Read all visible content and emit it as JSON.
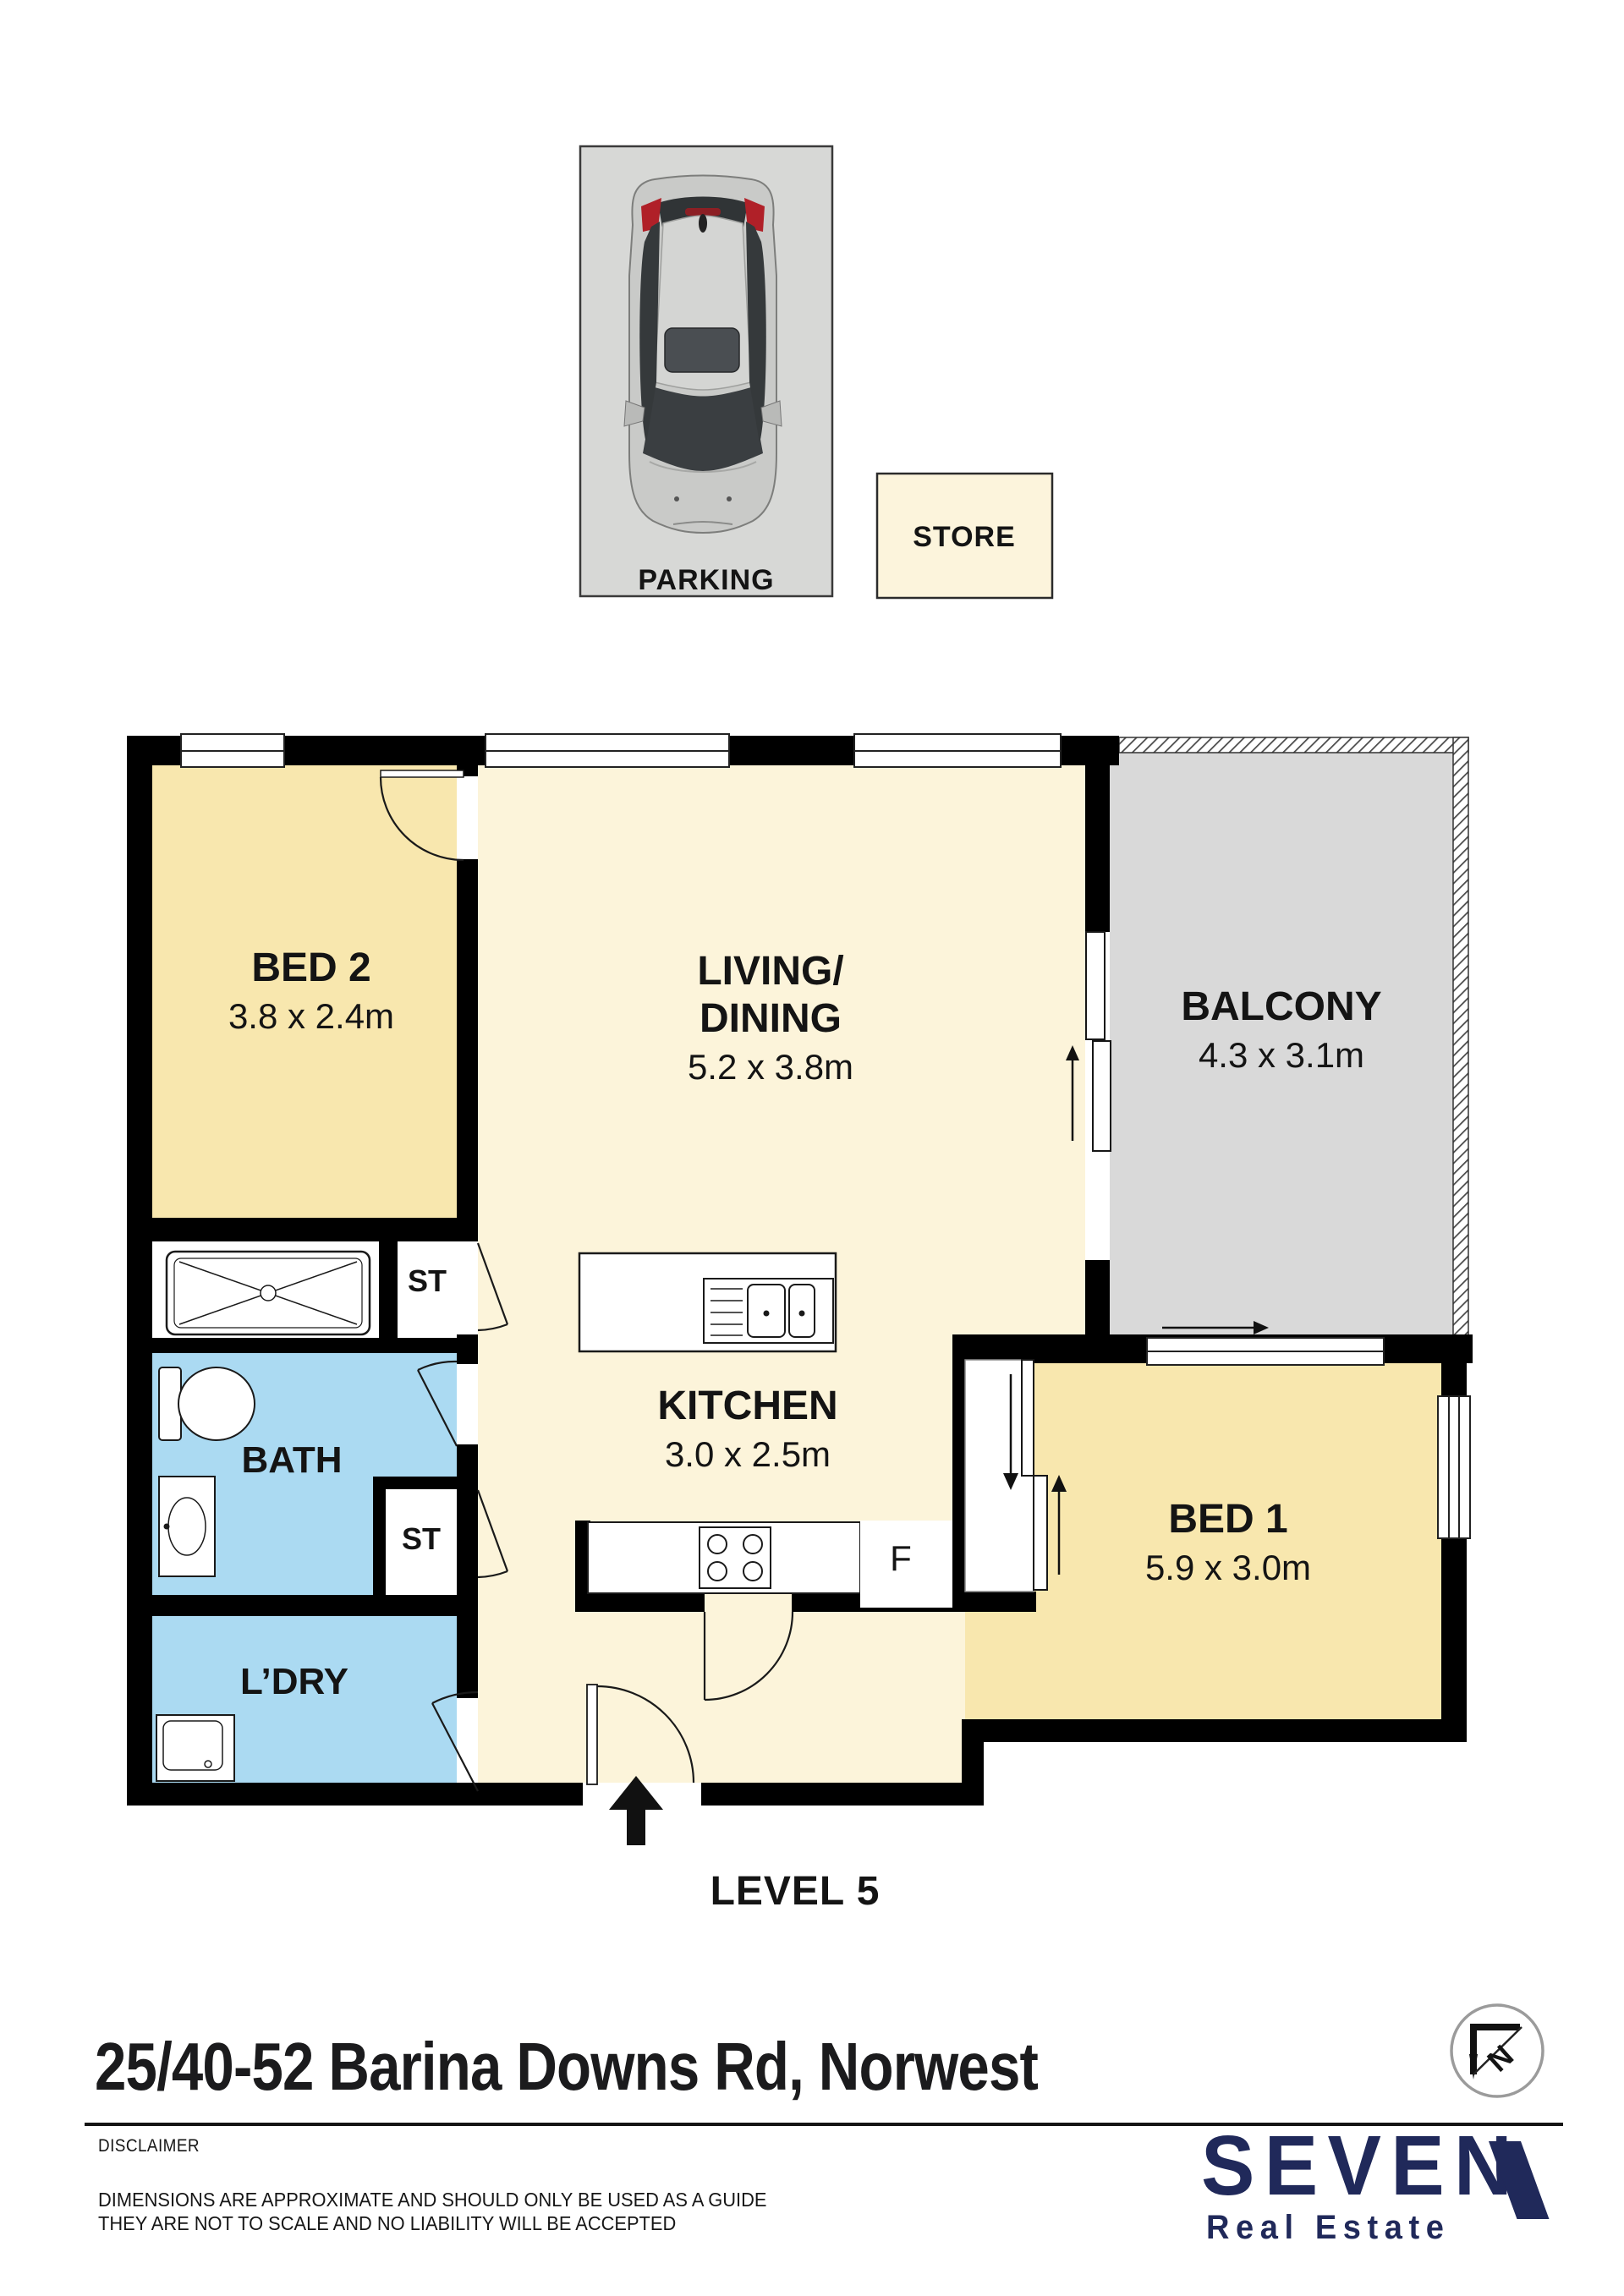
{
  "parking": {
    "label": "PARKING",
    "store_label": "STORE"
  },
  "rooms": {
    "bed2": {
      "name": "BED 2",
      "dims": "3.8 x 2.4m"
    },
    "living": {
      "name1": "LIVING/",
      "name2": "DINING",
      "dims": "5.2 x 3.8m"
    },
    "balcony": {
      "name": "BALCONY",
      "dims": "4.3 x 3.1m"
    },
    "bed1": {
      "name": "BED 1",
      "dims": "5.9 x 3.0m"
    },
    "kitchen": {
      "name": "KITCHEN",
      "dims": "3.0 x 2.5m"
    },
    "bath": {
      "name": "BATH"
    },
    "laundry": {
      "name": "L’DRY"
    },
    "store_upper": {
      "name": "ST"
    },
    "store_lower": {
      "name": "ST"
    },
    "fridge_label": "F"
  },
  "level_label": "LEVEL 5",
  "address": "25/40-52 Barina Downs Rd, Norwest",
  "compass": {
    "letter": "N"
  },
  "footer": {
    "disclaimer_title": "DISCLAIMER",
    "disclaimer_line1": "DIMENSIONS ARE APPROXIMATE AND SHOULD ONLY BE USED AS A GUIDE",
    "disclaimer_line2": "THEY ARE NOT TO SCALE AND NO LIABILITY WILL BE ACCEPTED",
    "brand_name": "SEVEN",
    "brand_subtitle": "Real Estate"
  },
  "colors": {
    "wall": "#000000",
    "bed": "#F8E7AE",
    "living": "#FCF4DA",
    "wet": "#ABDAF2",
    "balcony": "#D9D9D9",
    "parking": "#D7D8D6",
    "store": "#FCF4DC",
    "navy": "#20295A",
    "ink": "#111111",
    "glass": "#34383B",
    "car_body": "#C9CAC8",
    "tail_light": "#B02028"
  }
}
